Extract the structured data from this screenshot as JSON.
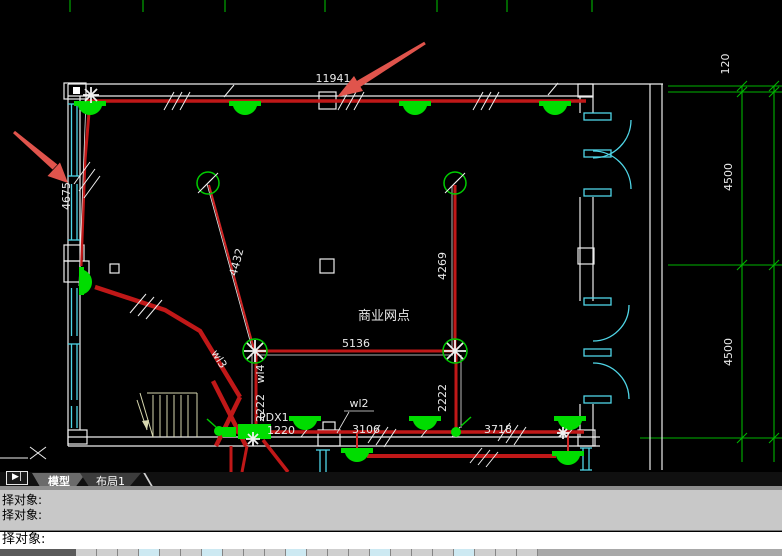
{
  "window": {
    "tab_nav_icon": "▶|",
    "tabs": [
      {
        "label": "模型",
        "active": true
      },
      {
        "label": "布局1",
        "active": false
      }
    ],
    "command_history": [
      "择对象:",
      "择对象:"
    ],
    "command_prompt": "择对象:"
  },
  "drawing": {
    "room_label": "商业网点",
    "panel_label": "PDX1",
    "circuit_labels": {
      "wl2": "wl2",
      "wl3": "wl3",
      "wl4": "wl4"
    },
    "dimensions": {
      "top_wall": "11941",
      "left_wall": "4675",
      "fan_feed_diagonal": "4432",
      "fan_feed_vertical": "4269",
      "junction_span": "5136",
      "panel_riser": "2222",
      "right_riser": "2222",
      "bottom_1": "1220",
      "bottom_2": "3106",
      "bottom_3": "3718",
      "right_offset": "120",
      "right_bay_upper": "4500",
      "right_bay_lower": "4500"
    },
    "colors": {
      "background": "#000000",
      "wall": "#ededed",
      "window_door": "#4fd5e6",
      "wire": "#c01818",
      "fixture": "#00dd00",
      "dimension_line": "#00b400",
      "text": "#eaeaea",
      "annotation_arrow": "#e0544c"
    }
  }
}
